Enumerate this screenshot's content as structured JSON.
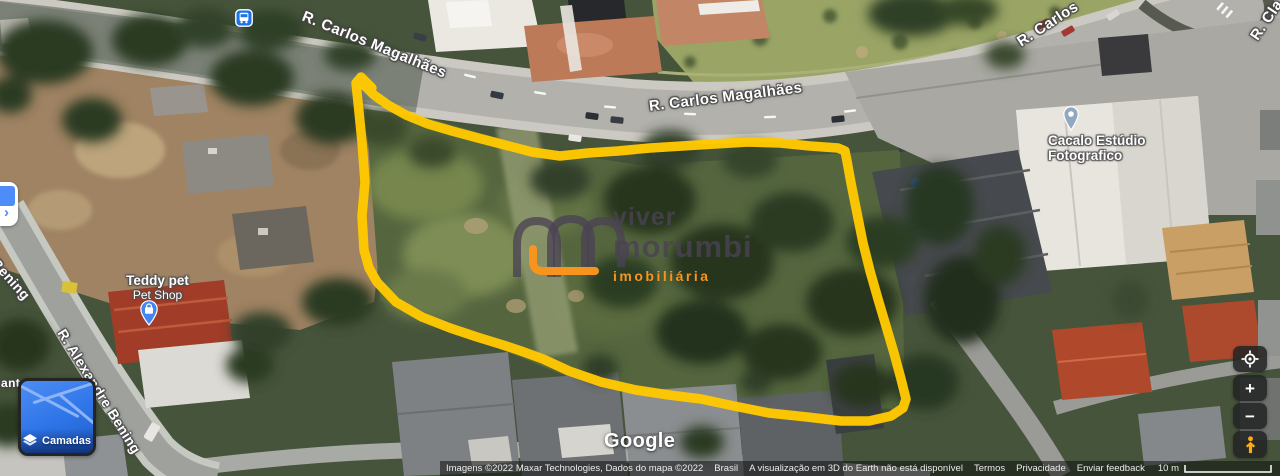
{
  "map_type": "satellite",
  "highlight": {
    "color": "#FFC800",
    "meaning": "property-outline"
  },
  "street_labels": {
    "carlos_1": "R. Carlos Magalhães",
    "carlos_2": "R. Carlos Magalhães",
    "carlos_partial": "R. Carlos",
    "cla_partial": "R. Cla",
    "bening_partial": "e Bening",
    "alexandre": "R. Alexandre Bening",
    "ante_partial": "ante"
  },
  "pois": {
    "teddy_pet": {
      "title": "Teddy pet",
      "subtitle": "Pet Shop",
      "pin_color": "#4285F4"
    },
    "cacalo": {
      "title": "Cacalo Estúdio",
      "title2": "Fotografico",
      "pin_color": "#92A8BF"
    }
  },
  "watermark": {
    "word1": "viver",
    "word2": "morumbi",
    "word3": "imobiliária",
    "accent_color": "#F7941E",
    "text_color": "#4A4253"
  },
  "logo": {
    "google": "Google"
  },
  "attribution": {
    "imagery": "Imagens ©2022 Maxar Technologies, Dados do mapa ©2022",
    "region": "Brasil",
    "notice": "A visualização em 3D do Earth não está disponível",
    "terms": "Termos",
    "privacy": "Privacidade",
    "feedback": "Enviar feedback",
    "scale_label": "10 m"
  },
  "controls": {
    "layers_label": "Camadas",
    "zoom_in": "+",
    "zoom_out": "−"
  },
  "icons": {
    "bus": "transit-stop-bus",
    "layers": "stacked-layers",
    "my_location": "compass-ring",
    "pegman": "street-view-person",
    "shop_pin": "shopping-bag-pin",
    "place_pin": "dot-pin",
    "chevron": "›"
  }
}
